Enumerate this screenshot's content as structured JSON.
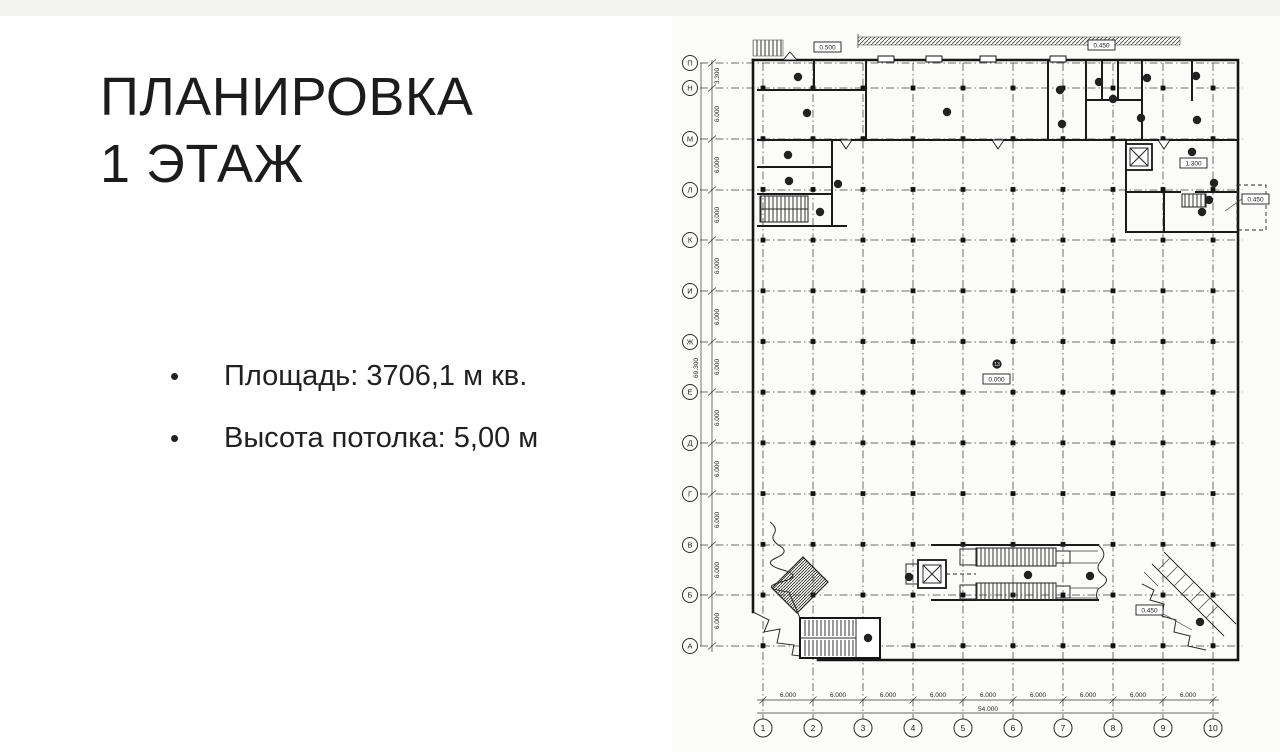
{
  "slide": {
    "title_line1": "ПЛАНИРОВКА",
    "title_line2": "1 ЭТАЖ",
    "bullets": [
      {
        "text": "Площадь: 3706,1 м кв."
      },
      {
        "text": "Высота потолка: 5,00 м"
      }
    ]
  },
  "plan": {
    "row_axes": [
      "П",
      "Н",
      "М",
      "Л",
      "К",
      "И",
      "Ж",
      "Е",
      "Д",
      "Г",
      "В",
      "Б",
      "А"
    ],
    "col_axes": [
      "1",
      "2",
      "3",
      "4",
      "5",
      "6",
      "7",
      "8",
      "9",
      "10"
    ],
    "left_dims": [
      "3.300",
      "6.000",
      "6.000",
      "6.000",
      "6.000",
      "6.000",
      "6.000",
      "6.000",
      "6.000",
      "6.000",
      "6.000",
      "6.000"
    ],
    "left_total": "69.300",
    "bottom_dims": [
      "6.000",
      "6.000",
      "6.000",
      "6.000",
      "6.000",
      "6.000",
      "6.000",
      "6.000",
      "6.000"
    ],
    "bottom_total": "54.000",
    "center_room": "13",
    "levels": {
      "top_left": "0.500",
      "top_right": "0.450",
      "mid_right": "1.300",
      "right_edge": "0.450",
      "center": "0.000",
      "bottom_right": "0.450"
    }
  },
  "colors": {
    "ink": "#161616",
    "paper": "#fbfbf9",
    "accent_text": "#212121"
  }
}
